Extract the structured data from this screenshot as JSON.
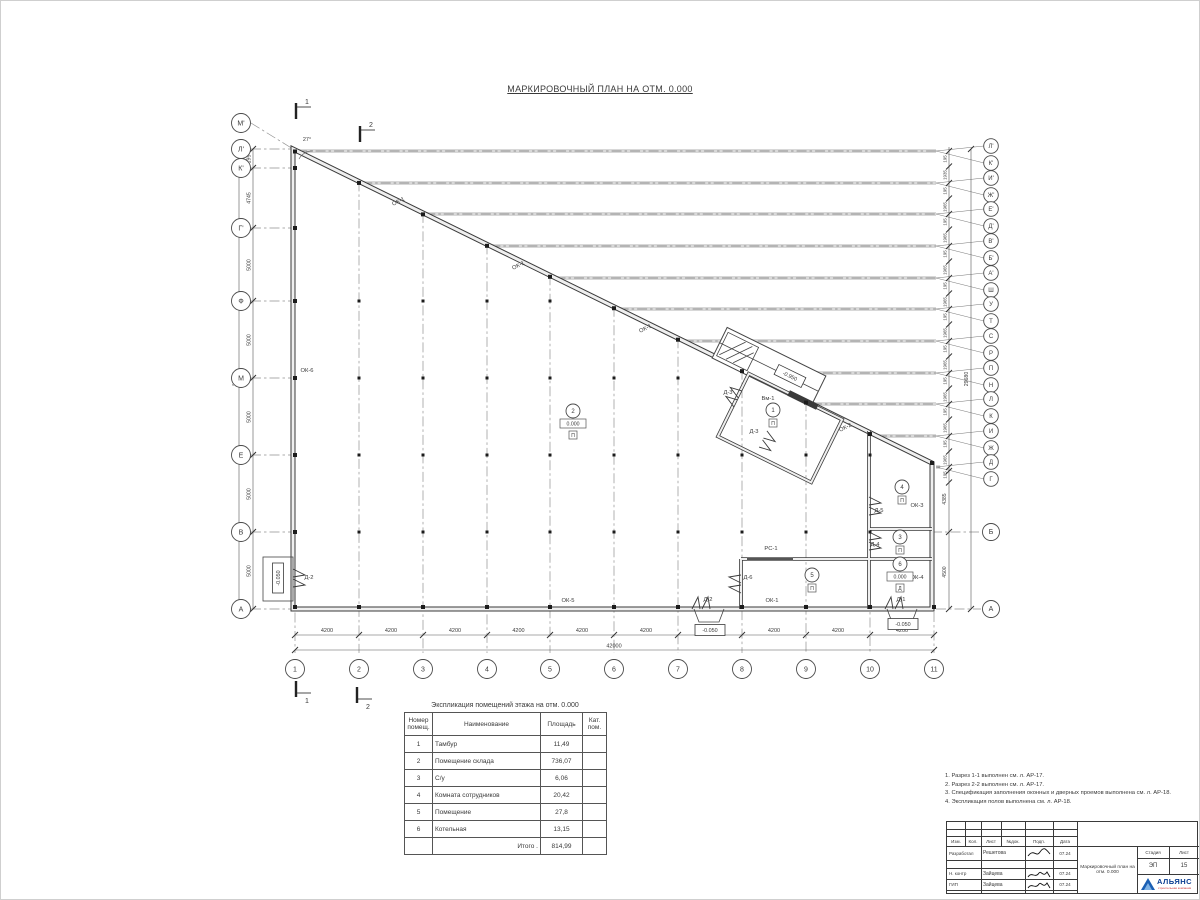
{
  "page_title": "МАРКИРОВОЧНЫЙ ПЛАН НА ОТМ. 0.000",
  "plan": {
    "angle_label": "27°",
    "left_axes": [
      {
        "label": "М'",
        "y": 122,
        "lx": 292,
        "ly": 148
      },
      {
        "label": "Л'",
        "y": 148,
        "lx": 292,
        "ly": 148
      },
      {
        "label": "К'",
        "y": 167,
        "lx": 292,
        "ly": 167
      },
      {
        "label": "Г'",
        "y": 227,
        "lx": 292,
        "ly": 227
      },
      {
        "label": "Ф",
        "y": 300,
        "lx": 292,
        "ly": 300
      },
      {
        "label": "М",
        "y": 377,
        "lx": 292,
        "ly": 377
      },
      {
        "label": "Е",
        "y": 454,
        "lx": 292,
        "ly": 454
      },
      {
        "label": "В",
        "y": 531,
        "lx": 292,
        "ly": 531
      },
      {
        "label": "А",
        "y": 608,
        "lx": 292,
        "ly": 608
      }
    ],
    "right_axis_pairs": [
      {
        "top": "Л'",
        "bottom": "К'",
        "y": 150
      },
      {
        "top": "И'",
        "bottom": "Ж'",
        "y": 182
      },
      {
        "top": "Е'",
        "bottom": "Д'",
        "y": 213
      },
      {
        "top": "В'",
        "bottom": "Б'",
        "y": 245
      },
      {
        "top": "А'",
        "bottom": "Ш",
        "y": 277
      },
      {
        "top": "У",
        "bottom": "Т",
        "y": 308
      },
      {
        "top": "С",
        "bottom": "Р",
        "y": 340
      },
      {
        "top": "П",
        "bottom": "Н",
        "y": 372
      },
      {
        "top": "Л",
        "bottom": "К",
        "y": 403
      },
      {
        "top": "И",
        "bottom": "Ж",
        "y": 435
      },
      {
        "top": "Д",
        "bottom": "Г",
        "y": 466
      }
    ],
    "right_axes": [
      {
        "label": "Б",
        "y": 531
      },
      {
        "label": "А",
        "y": 608
      }
    ],
    "bottom_axes": [
      {
        "label": "1",
        "x": 294
      },
      {
        "label": "2",
        "x": 358
      },
      {
        "label": "3",
        "x": 422
      },
      {
        "label": "4",
        "x": 486
      },
      {
        "label": "5",
        "x": 549
      },
      {
        "label": "6",
        "x": 613
      },
      {
        "label": "7",
        "x": 677
      },
      {
        "label": "8",
        "x": 741
      },
      {
        "label": "9",
        "x": 805
      },
      {
        "label": "10",
        "x": 869
      },
      {
        "label": "11",
        "x": 933
      }
    ],
    "bottom_dim_segments": [
      "4200",
      "4200",
      "4200",
      "4200",
      "4200",
      "4200",
      "4200",
      "4200",
      "4200",
      "4200"
    ],
    "bottom_dim_total": "42000",
    "left_dim_segments": [
      {
        "label": "195",
        "y": 158
      },
      {
        "label": "4745",
        "y": 197
      },
      {
        "label": "5000",
        "y": 264
      },
      {
        "label": "5000",
        "y": 339
      },
      {
        "label": "5000",
        "y": 416
      },
      {
        "label": "5000",
        "y": 493
      },
      {
        "label": "5000",
        "y": 570
      }
    ],
    "left_dim_total": {
      "label": "29680",
      "y": 378
    },
    "right_dim_pattern": {
      "narrow": "195",
      "first_wide": "1935",
      "wide": "1965"
    },
    "right_dim_lower": [
      {
        "label": "4385",
        "y": 498
      },
      {
        "label": "4500",
        "y": 571
      }
    ],
    "right_dim_total": {
      "label": "29680",
      "y": 378
    },
    "window_labels": [
      {
        "label": "ОК-1",
        "x": 398,
        "y": 202,
        "rot": -26
      },
      {
        "label": "ОК-1",
        "x": 518,
        "y": 266,
        "rot": -26
      },
      {
        "label": "ОК-1",
        "x": 645,
        "y": 329,
        "rot": -26
      },
      {
        "label": "ОК-2",
        "x": 845,
        "y": 428,
        "rot": -26
      },
      {
        "label": "ОК-6",
        "x": 306,
        "y": 371,
        "rot": 0
      },
      {
        "label": "ОК-5",
        "x": 567,
        "y": 601,
        "rot": 0
      },
      {
        "label": "ОК-1",
        "x": 771,
        "y": 601,
        "rot": 0
      },
      {
        "label": "ОК-3",
        "x": 916,
        "y": 506,
        "rot": 0
      },
      {
        "label": "ОК-4",
        "x": 916,
        "y": 578,
        "rot": 0
      },
      {
        "label": "РС-1",
        "x": 770,
        "y": 549,
        "rot": 0
      },
      {
        "label": "Вм-1",
        "x": 767,
        "y": 399,
        "rot": 0
      }
    ],
    "door_labels": [
      {
        "label": "Д-2",
        "x": 308,
        "y": 578
      },
      {
        "label": "Д-2",
        "x": 707,
        "y": 600
      },
      {
        "label": "Д-1",
        "x": 900,
        "y": 600
      },
      {
        "label": "Д-3",
        "x": 727,
        "y": 393
      },
      {
        "label": "Д-3",
        "x": 753,
        "y": 432
      },
      {
        "label": "Д-5",
        "x": 878,
        "y": 511
      },
      {
        "label": "Д-4",
        "x": 874,
        "y": 545
      },
      {
        "label": "Д-6",
        "x": 747,
        "y": 578
      }
    ],
    "room_markers": [
      {
        "num": "1",
        "x": 772,
        "y": 409,
        "floor": "П"
      },
      {
        "num": "2",
        "x": 572,
        "y": 410,
        "elev": "0.000",
        "floor": "П"
      },
      {
        "num": "3",
        "x": 899,
        "y": 536,
        "floor": "П"
      },
      {
        "num": "4",
        "x": 901,
        "y": 486,
        "floor": "П"
      },
      {
        "num": "5",
        "x": 811,
        "y": 574,
        "floor": "П"
      },
      {
        "num": "6",
        "x": 899,
        "y": 563,
        "elev": "0.000",
        "floor": "Д"
      }
    ],
    "elev_boxes": [
      {
        "label": "-0.950",
        "x": 789,
        "y": 375,
        "rot": 26
      },
      {
        "label": "-0.050",
        "x": 709,
        "y": 629,
        "rot": 0
      },
      {
        "label": "-0.050",
        "x": 902,
        "y": 623,
        "rot": 0
      },
      {
        "label": "-0.050",
        "x": 277,
        "y": 577,
        "rot": -90
      }
    ],
    "section_marks": [
      {
        "label": "1",
        "x": 301,
        "y": 110,
        "dir": 1
      },
      {
        "label": "2",
        "x": 365,
        "y": 133,
        "dir": 1
      },
      {
        "label": "1",
        "x": 301,
        "y": 688,
        "dir": -1
      },
      {
        "label": "2",
        "x": 362,
        "y": 694,
        "dir": -1
      }
    ],
    "doors_geometry": [
      {
        "x": 700,
        "y": 608,
        "rot": 0
      },
      {
        "x": 893,
        "y": 608,
        "rot": 0
      },
      {
        "x": 292,
        "y": 577,
        "rot": 90
      },
      {
        "x": 740,
        "y": 583,
        "rot": -90
      },
      {
        "x": 868,
        "y": 505,
        "rot": 90
      },
      {
        "x": 868,
        "y": 540,
        "rot": 90
      },
      {
        "x": 737,
        "y": 398,
        "rot": -64
      },
      {
        "x": 762,
        "y": 438,
        "rot": 116
      }
    ]
  },
  "explication": {
    "title": "Экспликация помещений этажа на отм. 0.000",
    "headers": [
      "Номер помещ.",
      "Наименование",
      "Площадь",
      "Кат. пом."
    ],
    "rows": [
      [
        "1",
        "Тамбур",
        "11,49",
        ""
      ],
      [
        "2",
        "Помещение склада",
        "736,07",
        ""
      ],
      [
        "3",
        "С/у",
        "6,06",
        ""
      ],
      [
        "4",
        "Комната сотрудников",
        "20,42",
        ""
      ],
      [
        "5",
        "Помещение",
        "27,8",
        ""
      ],
      [
        "6",
        "Котельная",
        "13,15",
        ""
      ]
    ],
    "total_label": "Итого .",
    "total_value": "814,99"
  },
  "notes": [
    "1. Разрез 1-1 выполнен см. л. АР-17.",
    "2. Разрез 2-2 выполнен см. л. АР-17.",
    "3. Спецификация заполнения оконных и дверных проемов выполнена см. л. АР-18.",
    "4. Экспликация полов выполнена см. л. АР-18."
  ],
  "stamp": {
    "header_cells": [
      "Изм.",
      "Кол.",
      "Лист",
      "№док.",
      "Подп.",
      "Дата"
    ],
    "rows": [
      {
        "role": "Разработал",
        "name": "Решетова",
        "date": "07.24"
      },
      {
        "role": "Н. контр",
        "name": "Зайцева",
        "date": "07.24"
      },
      {
        "role": "ГИП",
        "name": "Зайцева",
        "date": "07.24"
      }
    ],
    "doc_title": "Маркировочный план на отм. 0.000",
    "stage_label": "Стадия",
    "stage_value": "ЭП",
    "sheet_label": "Лист",
    "sheet_value": "15",
    "logo_text": "АЛЬЯНС",
    "logo_sub": "строительная компания"
  }
}
